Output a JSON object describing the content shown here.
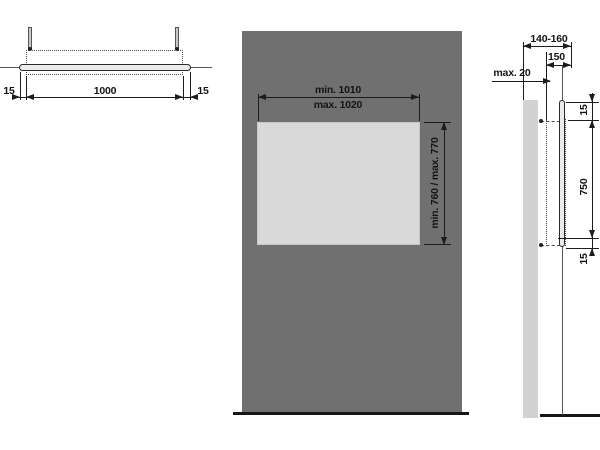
{
  "colors": {
    "background": "#ffffff",
    "panel": "#707070",
    "wall_light": "#d2d2d2",
    "mirror_face": "#d9d9d9",
    "profile_fill": "#ececec",
    "line_dark": "#1c1c1c",
    "line_mid": "#555555",
    "text": "#141414"
  },
  "views": {
    "plan": {
      "dims": {
        "left_gap": "15",
        "width": "1000",
        "right_gap": "15"
      }
    },
    "front": {
      "dims": {
        "width_min": "min. 1010",
        "width_max": "max. 1020",
        "height_range": "min. 760 / max. 770"
      }
    },
    "side": {
      "dims": {
        "depth_range": "140-160",
        "depth": "150",
        "wall_clearance": "max. 20",
        "top_gap": "15",
        "height": "750",
        "bottom_gap": "15"
      }
    }
  }
}
